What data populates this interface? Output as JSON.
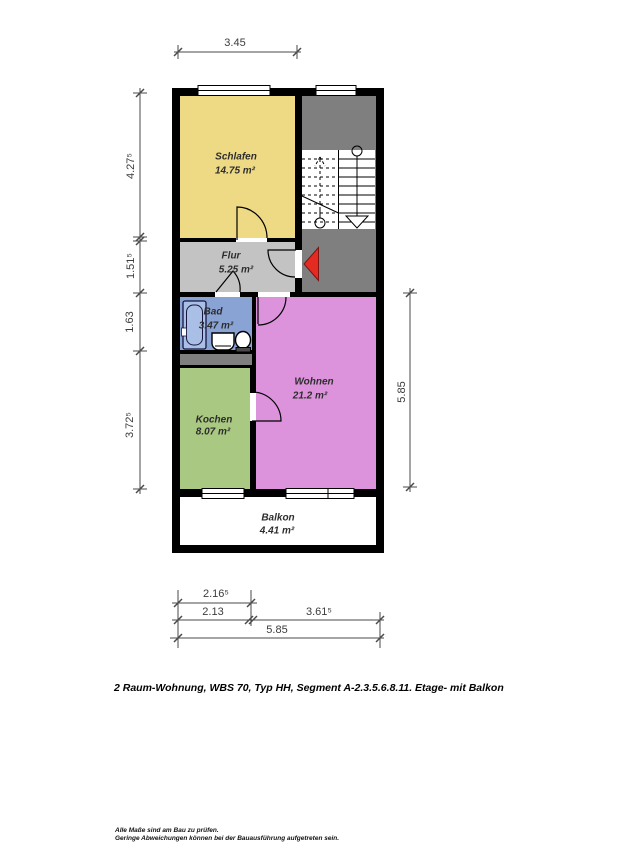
{
  "caption": {
    "text": "2 Raum-Wohnung, WBS 70, Typ HH, Segment A-2.3.5.6.8.11. Etage- mit Balkon"
  },
  "footnote": {
    "line1": "Alle Maße sind am Bau zu prüfen.",
    "line2": "Geringe Abweichungen können bei der Bauausführung aufgetreten sein."
  },
  "rooms": {
    "schlafen": {
      "name": "Schlafen",
      "area": "14.75 m²",
      "color": "#eeda85"
    },
    "flur": {
      "name": "Flur",
      "area": "5.25 m²",
      "color": "#c3c3c3"
    },
    "bad": {
      "name": "Bad",
      "area": "3.47 m²",
      "color": "#89a3d4"
    },
    "wohnen": {
      "name": "Wohnen",
      "area": "21.2 m²",
      "color": "#dc93dc"
    },
    "kochen": {
      "name": "Kochen",
      "area": "8.07 m²",
      "color": "#a9c881"
    },
    "balkon": {
      "name": "Balkon",
      "area": "4.41 m²",
      "color": "#ffffff"
    }
  },
  "dimensions": {
    "top_width": "3.45",
    "left": [
      "4.27⁵",
      "1.51⁵",
      "1.63",
      "3.72⁵"
    ],
    "right_height": "5.85",
    "bottom": [
      "2.16⁵",
      "2.13",
      "3.61⁵",
      "5.85"
    ]
  },
  "colors": {
    "wall": "#000000",
    "stairwell_floor": "#7f7f7f",
    "entrance_arrow": "#e32b21",
    "bathtub_fill": "#a9bfe6"
  }
}
